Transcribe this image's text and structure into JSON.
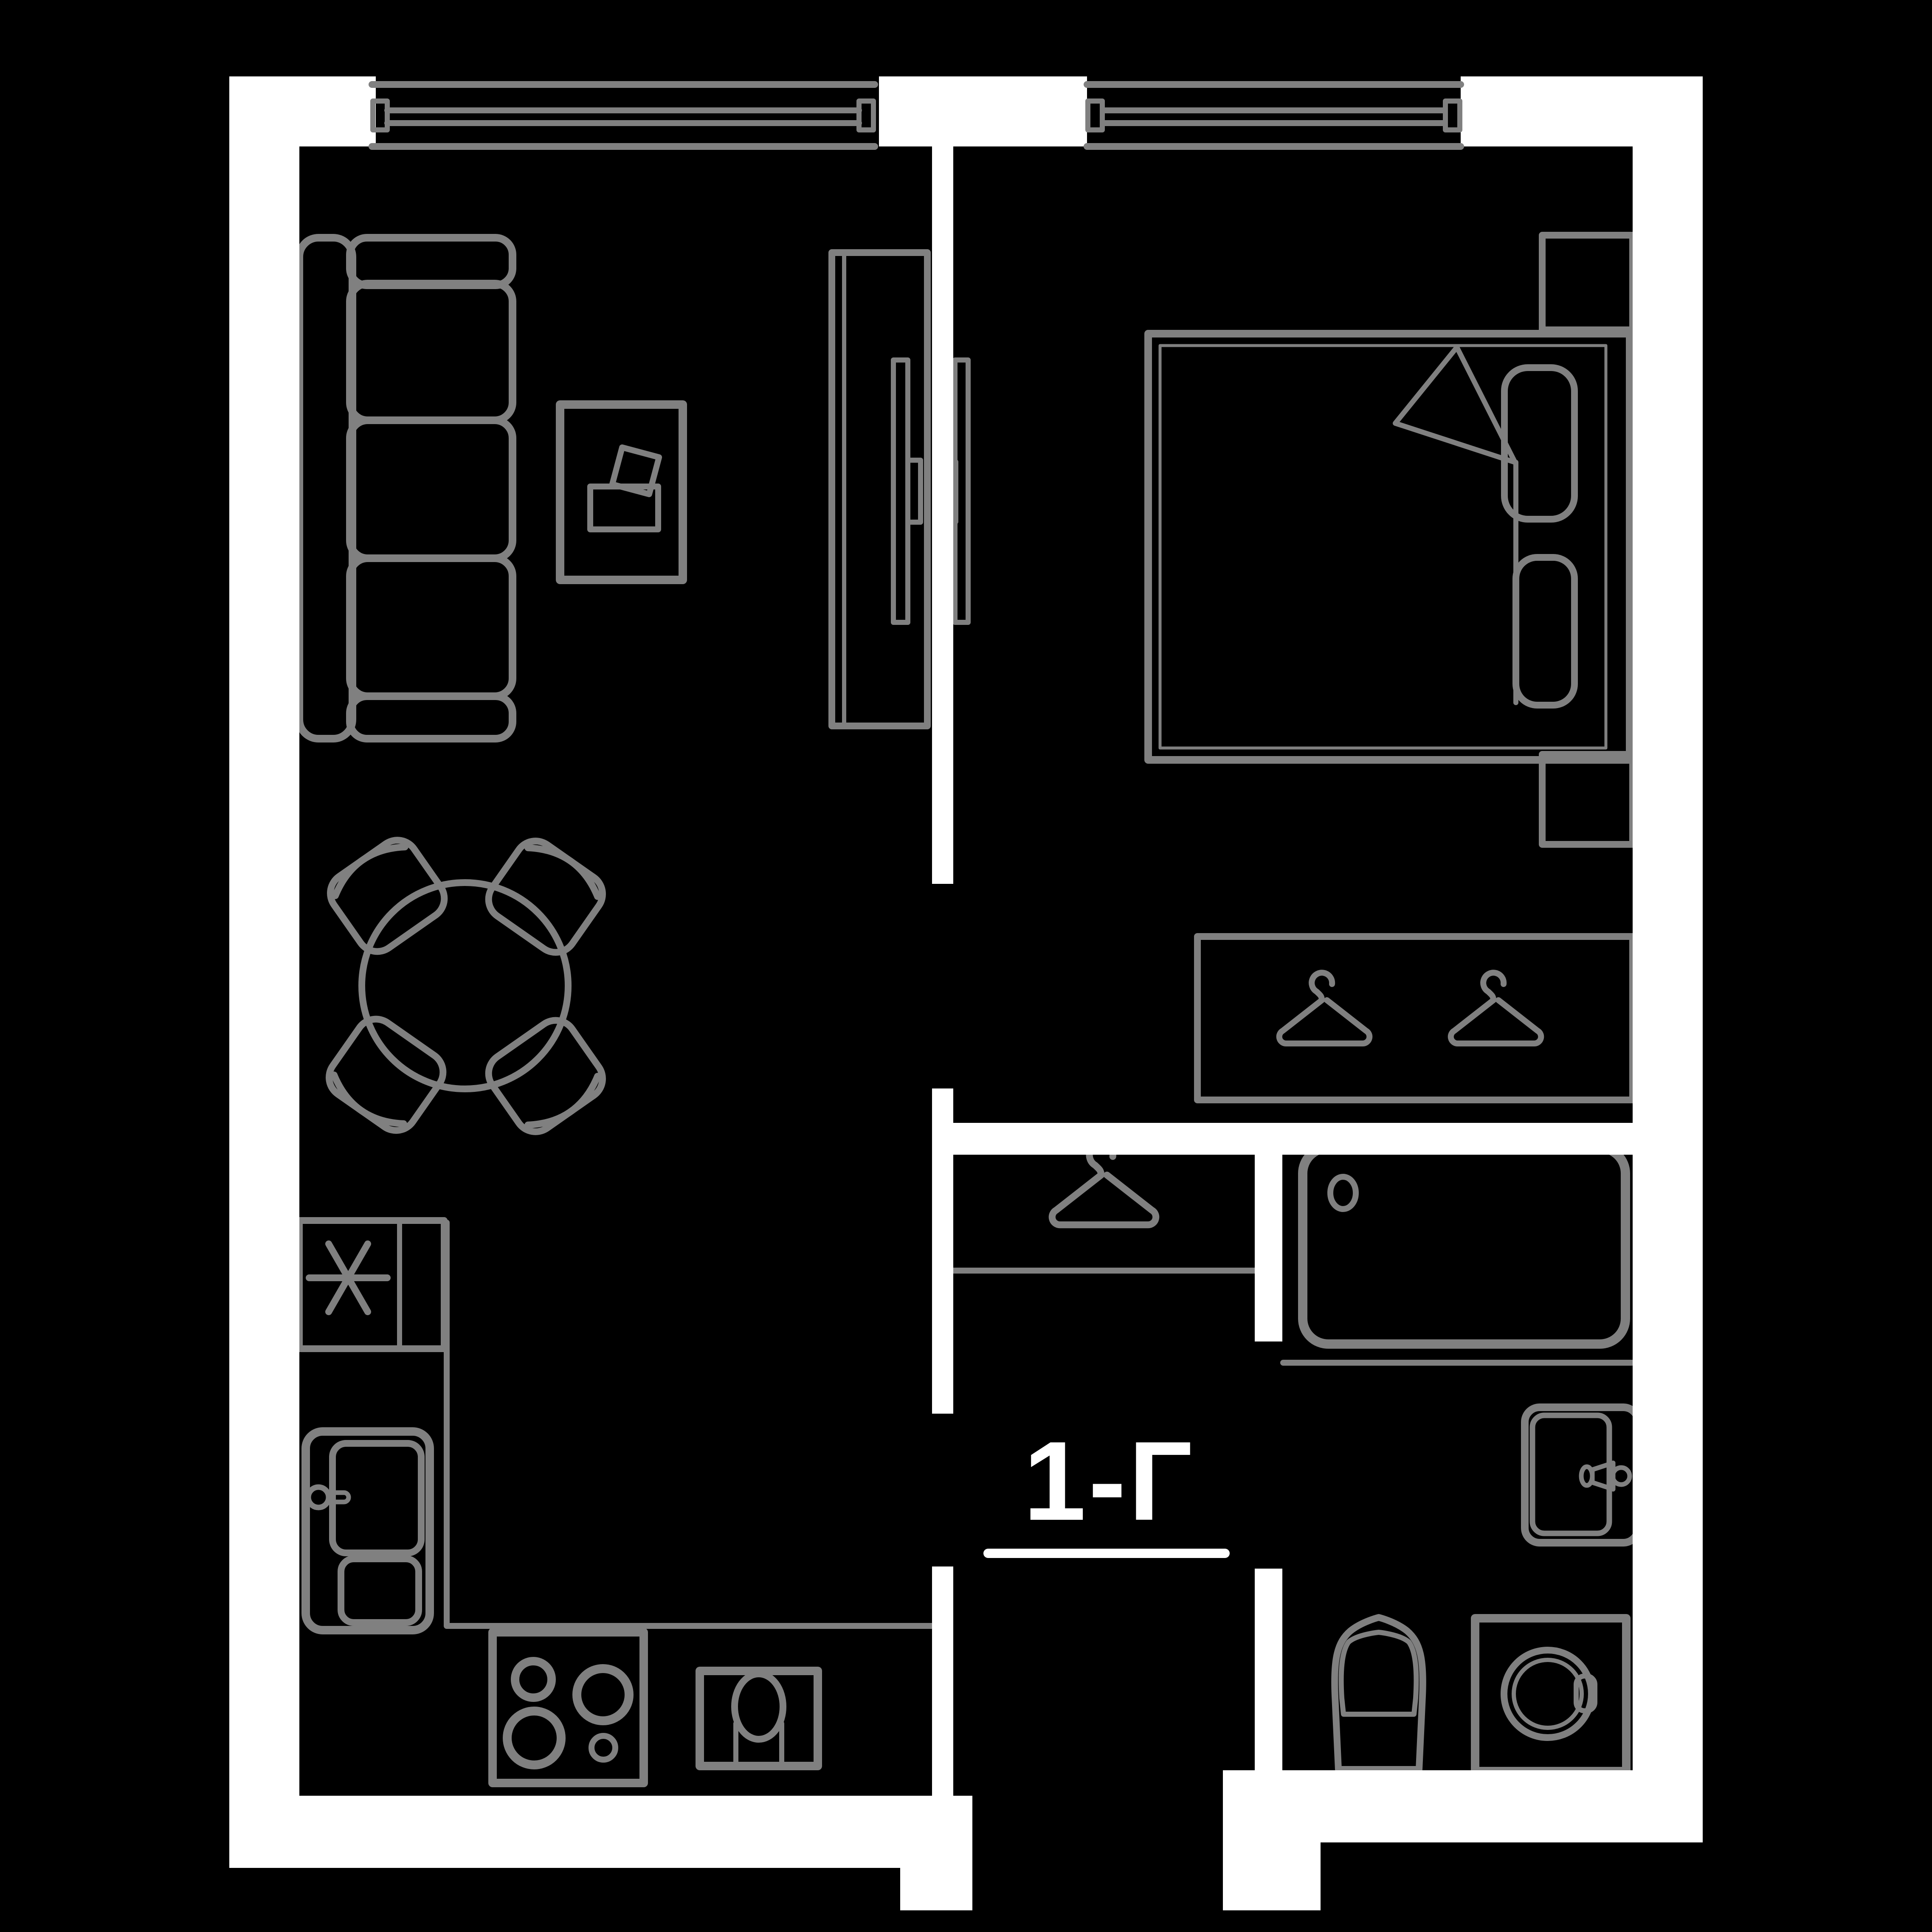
{
  "unit": {
    "label": "1-Г"
  },
  "colors": {
    "background": "#000000",
    "walls": "#ffffff",
    "furniture_lines": "#808080",
    "label": "#ffffff"
  }
}
